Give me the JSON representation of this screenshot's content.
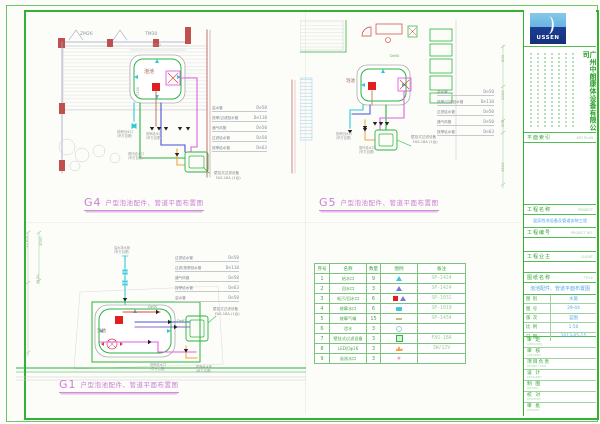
{
  "palette": {
    "frame_green": "#33b133",
    "title_magenta": "#c97fd2",
    "value_blue": "#58a8e8",
    "table_green": "#4aa44a",
    "pipe_green": "#2ab43c",
    "pipe_magenta": "#e060e0",
    "pipe_blue": "#4850d8",
    "pipe_cyan": "#2ec8dc",
    "pipe_orange": "#f5a040",
    "wall_red": "#c0504d",
    "device_red": "#e02020"
  },
  "titles": {
    "g4": {
      "code": "G4",
      "text": "户型泡池配件、管道平面布置图"
    },
    "g5": {
      "code": "G5",
      "text": "户型泡池配件、管道平面布置图"
    },
    "g1": {
      "code": "G1",
      "text": "户型泡池配件、管道平面布置图"
    }
  },
  "drawings": {
    "g4": {
      "pipes": [
        {
          "label": "溢水管",
          "size": "De50"
        },
        {
          "label": "按摩/过滤回水管",
          "size": "De110"
        },
        {
          "label": "通气风管",
          "size": "De50"
        },
        {
          "label": "过滤给水管",
          "size": "De50"
        },
        {
          "label": "按摩给水管",
          "size": "De63"
        }
      ]
    },
    "g5": {
      "pipes": [
        {
          "label": "溢水管",
          "size": "De50"
        },
        {
          "label": "按摩/过滤回水管",
          "size": "De110"
        },
        {
          "label": "过滤给水管",
          "size": "De50"
        },
        {
          "label": "通气风管",
          "size": "De50"
        },
        {
          "label": "按摩给水管",
          "size": "De63"
        }
      ]
    },
    "g1": {
      "pipes": [
        {
          "label": "过滤给水管",
          "size": "De50"
        },
        {
          "label": "过滤/按摩回水管",
          "size": "De110"
        },
        {
          "label": "通气风管",
          "size": "De50"
        },
        {
          "label": "按摩给水管",
          "size": "De63"
        },
        {
          "label": "溢水管",
          "size": "De50"
        }
      ]
    }
  },
  "equipment_table": {
    "headers": [
      "序号",
      "名称",
      "数量",
      "图例",
      "备注"
    ],
    "rows": [
      {
        "seq": "1",
        "name": "给水口",
        "qty": "9",
        "legend": "tri-cyan",
        "remark": "SP-1424"
      },
      {
        "seq": "2",
        "name": "回水口",
        "qty": "3",
        "legend": "tri-blue",
        "remark": "SP-1424"
      },
      {
        "seq": "3",
        "name": "吸污/回水口",
        "qty": "6",
        "legend": "sq-red",
        "remark": "SP-1032"
      },
      {
        "seq": "4",
        "name": "按摩水口",
        "qty": "6",
        "legend": "dev-cyan",
        "remark": "SP-1019"
      },
      {
        "seq": "5",
        "name": "按摩气嘴",
        "qty": "15",
        "legend": "dash-tan",
        "remark": "SP-1434"
      },
      {
        "seq": "6",
        "name": "泄水",
        "qty": "3",
        "legend": "ring",
        "remark": ""
      },
      {
        "seq": "7",
        "name": "壁挂式过滤设备",
        "qty": "3",
        "legend": "sq-green",
        "remark": "FAS-18A"
      },
      {
        "seq": "8",
        "name": "LED灯φ16",
        "qty": "3",
        "legend": "lamp-orange",
        "remark": "3W/12V"
      },
      {
        "seq": "9",
        "name": "溢流水口",
        "qty": "3",
        "legend": "star-pink",
        "remark": ""
      }
    ]
  },
  "title_block": {
    "logo_text": "USSEN",
    "company": "广州中朗康体设备有限公司",
    "key_plan_label": "平面索引",
    "key_plan_en": "KEY PLAN",
    "project_label": "工程名称",
    "project_en": "PROJECT",
    "project_name": "温泉泡池设备及管道安装工程",
    "project_no_label": "工程编号",
    "project_no_en": "PROJECT NO.",
    "client_label": "工程业主",
    "client_en": "CLIENT",
    "title_label": "图纸名称",
    "title_en": "TITLE",
    "drawing_title": "泡池配件、管道平面布置图",
    "fields": [
      {
        "label": "图 别",
        "value": "水施"
      },
      {
        "label": "图 号",
        "value": "29-44"
      },
      {
        "label": "版 次",
        "value": "蓝图"
      },
      {
        "label": "比 例",
        "value": "1:50"
      },
      {
        "label": "日 期",
        "value": "2013-05-15"
      }
    ],
    "sign_rows": [
      {
        "label": "审 定",
        "en": "APPROVED"
      },
      {
        "label": "审 核",
        "en": "CHECKED"
      },
      {
        "label": "项目负责",
        "en": "PROJECT MGR"
      },
      {
        "label": "设 计",
        "en": "DESIGNED"
      },
      {
        "label": "制 图",
        "en": "DRAWN"
      },
      {
        "label": "校 对",
        "en": "PROOFED"
      },
      {
        "label": "审 批",
        "en": "RATIFIED"
      }
    ]
  },
  "annotations": [
    {
      "t": "ZM26",
      "x": 80,
      "y": 33,
      "s": 4.5,
      "c": "#8a94a8"
    },
    {
      "t": "TM30",
      "x": 145,
      "y": 33,
      "s": 4.5,
      "c": "#8a94a8"
    },
    {
      "t": "泡池",
      "x": 144,
      "y": 70,
      "s": 5,
      "c": "#a06050"
    },
    {
      "t": "2550",
      "x": 152,
      "y": 44,
      "s": 3.5,
      "c": "#999999"
    },
    {
      "t": "3300",
      "x": 137,
      "y": 96,
      "s": 3.5,
      "c": "#999999",
      "r": -90
    },
    {
      "t": "按摩回水口",
      "x": 117,
      "y": 131,
      "s": 3.2,
      "c": "#9a9a9a"
    },
    {
      "t": "(甲方自理)",
      "x": 117,
      "y": 135,
      "s": 3.2,
      "c": "#9a9a9a"
    },
    {
      "t": "按摩给水口",
      "x": 146,
      "y": 133,
      "s": 3.2,
      "c": "#9a9a9a"
    },
    {
      "t": "(甲方自理)",
      "x": 146,
      "y": 137,
      "s": 3.2,
      "c": "#9a9a9a"
    },
    {
      "t": "循环给水口",
      "x": 128,
      "y": 153,
      "s": 3.2,
      "c": "#9a9a9a"
    },
    {
      "t": "(甲方自理)",
      "x": 128,
      "y": 157,
      "s": 3.2,
      "c": "#9a9a9a"
    },
    {
      "t": "壁挂式过滤设备",
      "x": 214,
      "y": 172,
      "s": 3.6,
      "c": "#8a8a8a"
    },
    {
      "t": "FAS-18A (1台)",
      "x": 216,
      "y": 177,
      "s": 3.6,
      "c": "#8a8a8a"
    },
    {
      "t": "De50",
      "x": 390,
      "y": 55,
      "s": 3.5,
      "c": "#66aa66"
    },
    {
      "t": "泡池",
      "x": 346,
      "y": 80,
      "s": 4.5,
      "c": "#a06050"
    },
    {
      "t": "按摩回水口",
      "x": 336,
      "y": 133,
      "s": 3.2,
      "c": "#9a9a9a"
    },
    {
      "t": "(甲方自理)",
      "x": 336,
      "y": 137,
      "s": 3.2,
      "c": "#9a9a9a"
    },
    {
      "t": "循环给水口",
      "x": 359,
      "y": 147,
      "s": 3.2,
      "c": "#9a9a9a"
    },
    {
      "t": "(甲方自理)",
      "x": 359,
      "y": 151,
      "s": 3.2,
      "c": "#9a9a9a"
    },
    {
      "t": "壁挂式过滤设备",
      "x": 411,
      "y": 136,
      "s": 3.6,
      "c": "#8a8a8a"
    },
    {
      "t": "FAS-18A (1台)",
      "x": 413,
      "y": 141,
      "s": 3.6,
      "c": "#8a8a8a"
    },
    {
      "t": "500",
      "x": 501,
      "y": 62,
      "s": 3.8,
      "c": "#88bb88",
      "r": -90
    },
    {
      "t": "2300",
      "x": 501,
      "y": 100,
      "s": 3.8,
      "c": "#88bb88",
      "r": -90
    },
    {
      "t": "500",
      "x": 501,
      "y": 127,
      "s": 3.8,
      "c": "#88bb88",
      "r": -90
    },
    {
      "t": "3500",
      "x": 501,
      "y": 172,
      "s": 3.8,
      "c": "#88bb88",
      "r": -90
    },
    {
      "t": "11300",
      "x": 25,
      "y": 248,
      "s": 3.8,
      "c": "#88bb88",
      "r": -90
    },
    {
      "t": "3000",
      "x": 39,
      "y": 246,
      "s": 3.8,
      "c": "#88bb88",
      "r": -90
    },
    {
      "t": "3100",
      "x": 36,
      "y": 284,
      "s": 3.8,
      "c": "#88bb88",
      "r": -90
    },
    {
      "t": "溢水排水管",
      "x": 114,
      "y": 247,
      "s": 3.2,
      "c": "#9a9a9a"
    },
    {
      "t": "(甲方自理)",
      "x": 114,
      "y": 251,
      "s": 3.2,
      "c": "#9a9a9a"
    },
    {
      "t": "泡池",
      "x": 97,
      "y": 330,
      "s": 4.5,
      "c": "#a06050"
    },
    {
      "t": "De50",
      "x": 148,
      "y": 306,
      "s": 3.5,
      "c": "#66aa66"
    },
    {
      "t": "De63",
      "x": 177,
      "y": 320,
      "s": 3.5,
      "c": "#66aa66"
    },
    {
      "t": "壁挂式过滤设备",
      "x": 213,
      "y": 308,
      "s": 3.6,
      "c": "#8a8a8a"
    },
    {
      "t": "FAS-18A (1台)",
      "x": 215,
      "y": 313,
      "s": 3.6,
      "c": "#8a8a8a"
    },
    {
      "t": "按摩给水口",
      "x": 150,
      "y": 364,
      "s": 3.2,
      "c": "#9a9a9a"
    },
    {
      "t": "(甲方自理)",
      "x": 150,
      "y": 368,
      "s": 3.2,
      "c": "#9a9a9a"
    },
    {
      "t": "按摩给水管",
      "x": 196,
      "y": 366,
      "s": 3.2,
      "c": "#9a9a9a"
    },
    {
      "t": "(甲方自理)",
      "x": 196,
      "y": 370,
      "s": 3.2,
      "c": "#9a9a9a"
    }
  ]
}
